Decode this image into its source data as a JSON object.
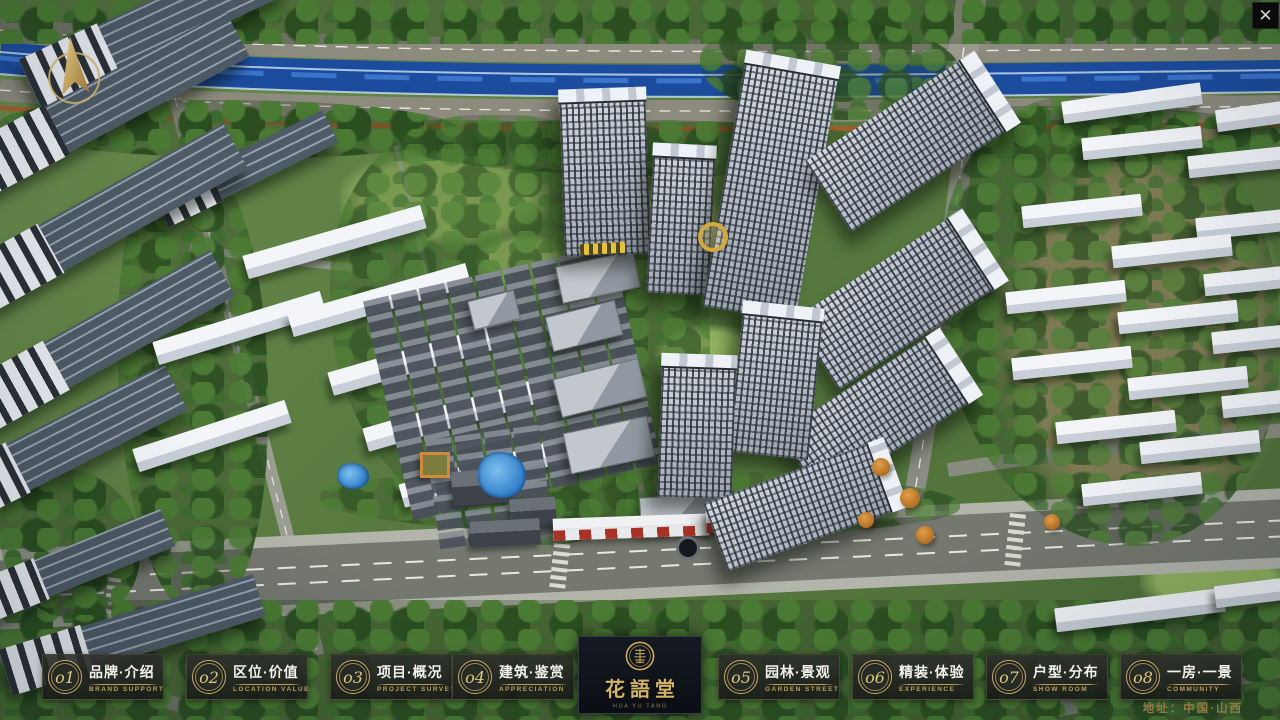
{
  "window": {
    "close_icon": "✕"
  },
  "nav": {
    "items": [
      {
        "num": "o1",
        "title": "品牌·介绍",
        "subtitle": "BRAND SUPPORT"
      },
      {
        "num": "o2",
        "title": "区位·价值",
        "subtitle": "LOCATION VALUE"
      },
      {
        "num": "o3",
        "title": "项目·概况",
        "subtitle": "PROJECT SURVEY"
      },
      {
        "num": "o4",
        "title": "建筑·鉴赏",
        "subtitle": "APPRECIATION"
      },
      {
        "num": "o5",
        "title": "园林·景观",
        "subtitle": "GARDEN STREET"
      },
      {
        "num": "o6",
        "title": "精装·体验",
        "subtitle": "EXPERIENCE"
      },
      {
        "num": "o7",
        "title": "户型·分布",
        "subtitle": "SHOW ROOM"
      },
      {
        "num": "o8",
        "title": "一房·一景",
        "subtitle": "COMMUNITY"
      }
    ]
  },
  "logo": {
    "name": "花語堂",
    "tagline": "HUA YU TANG"
  },
  "footer": {
    "address": "地址：中国·山西"
  },
  "colors": {
    "gold": "#c9a95c",
    "panel": "#1d1f1c",
    "river": "#1c4c9e",
    "logo_bg": "#10141c"
  }
}
